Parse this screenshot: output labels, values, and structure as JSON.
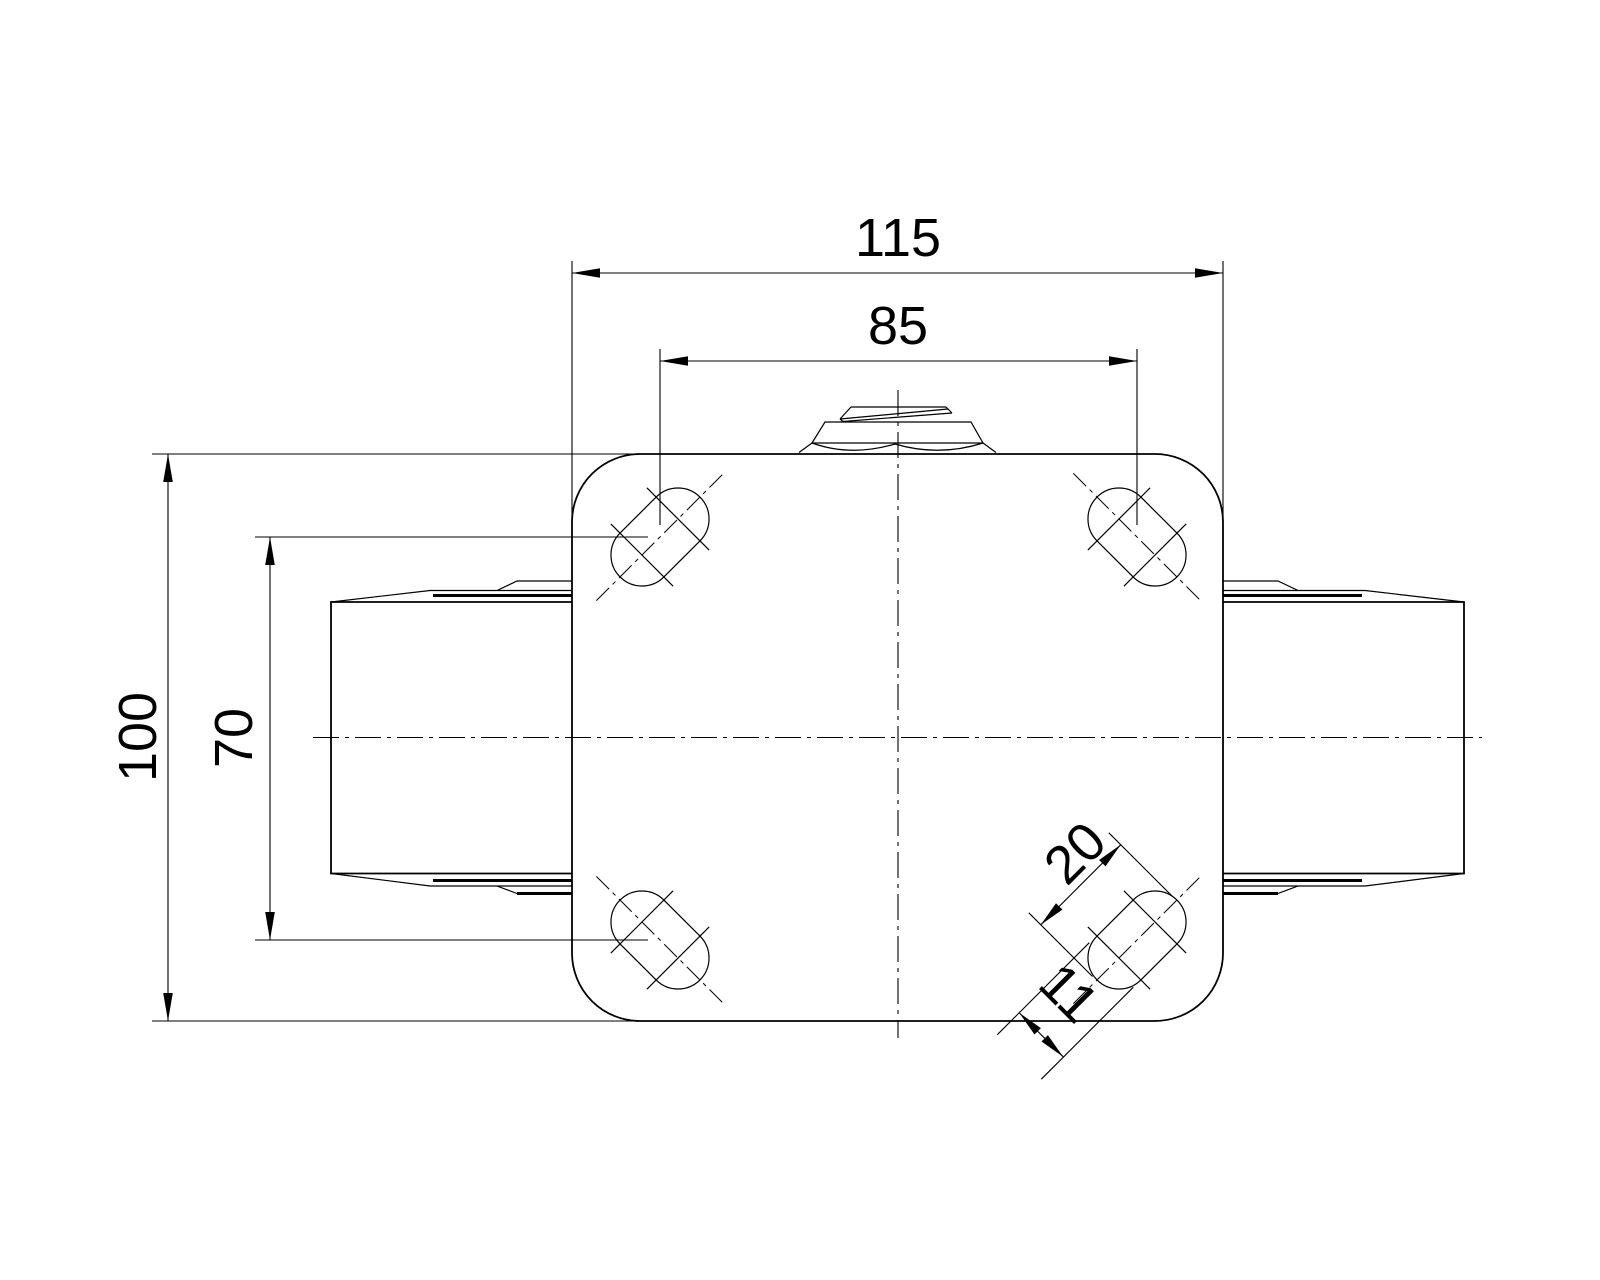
{
  "drawing": {
    "type": "engineering-drawing",
    "view": "caster-top-plate-plan-view",
    "dimensions": {
      "plate_width": "115",
      "bolt_hole_spacing_horizontal": "85",
      "plate_height": "100",
      "bolt_hole_spacing_vertical": "70",
      "slot_length": "20",
      "slot_width": "11"
    },
    "colors": {
      "line": "#000000",
      "background": "#ffffff"
    }
  }
}
